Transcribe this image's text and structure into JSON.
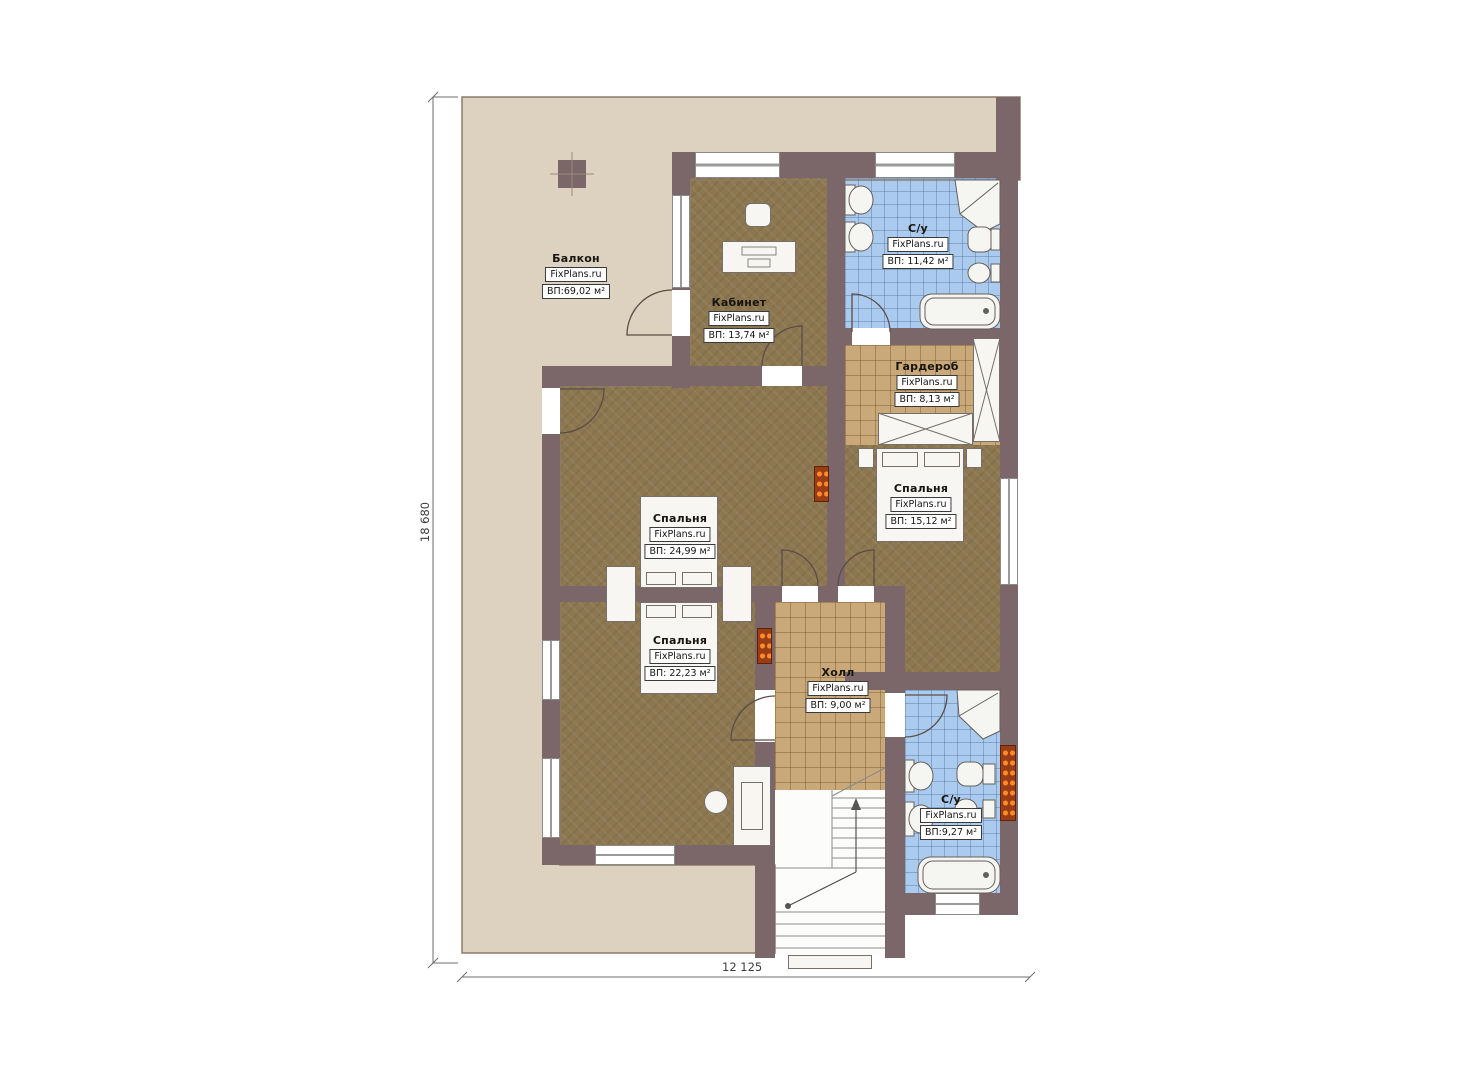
{
  "plan": {
    "title": "Floor plan",
    "rooms": [
      {
        "id": "balcony",
        "name": "Балкон",
        "brand": "FixPlans.ru",
        "area": "ВП:69,02 м²"
      },
      {
        "id": "office",
        "name": "Кабинет",
        "brand": "FixPlans.ru",
        "area": "ВП: 13,74 м²"
      },
      {
        "id": "bathroom-top",
        "name": "С/у",
        "brand": "FixPlans.ru",
        "area": "ВП: 11,42 м²"
      },
      {
        "id": "wardrobe",
        "name": "Гардероб",
        "brand": "FixPlans.ru",
        "area": "ВП: 8,13 м²"
      },
      {
        "id": "bedroom-right",
        "name": "Спальня",
        "brand": "FixPlans.ru",
        "area": "ВП: 15,12 м²"
      },
      {
        "id": "bedroom-center",
        "name": "Спальня",
        "brand": "FixPlans.ru",
        "area": "ВП: 24,99 м²"
      },
      {
        "id": "bedroom-lower",
        "name": "Спальня",
        "brand": "FixPlans.ru",
        "area": "ВП: 22,23 м²"
      },
      {
        "id": "hall",
        "name": "Холл",
        "brand": "FixPlans.ru",
        "area": "ВП: 9,00 м²"
      },
      {
        "id": "bathroom-bottom",
        "name": "С/у",
        "brand": "FixPlans.ru",
        "area": "ВП:9,27 м²"
      }
    ],
    "dimensions": {
      "height_label": "18 680",
      "width_label": "12 125"
    },
    "colors": {
      "wall": "#7b676a",
      "balcony": "#ddd2bf",
      "floor_brown": "#8c7750",
      "tile_tan": "#c9a97a",
      "tile_blue": "#aacbee",
      "radiator_dot": "#ff8c28"
    }
  }
}
